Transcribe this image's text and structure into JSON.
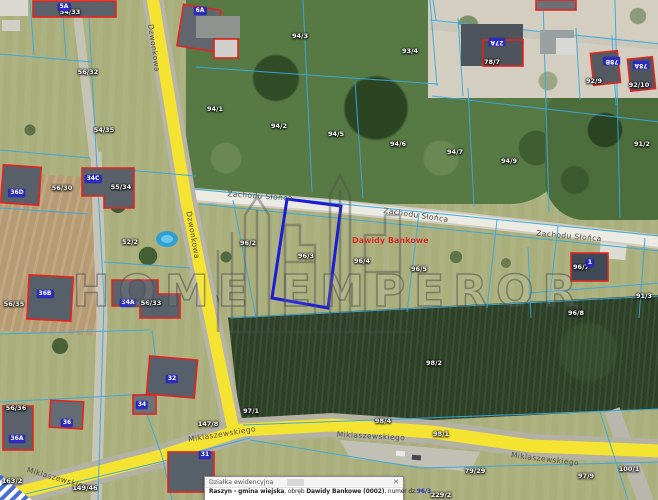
{
  "watermark": {
    "text": "HOME EMPEROR"
  },
  "map": {
    "place_label": "Dawidy Bankowe",
    "selected_parcel": "96/3",
    "colors": {
      "selected_parcel_outline": "#1b1bd9",
      "parcel_boundary_line": "#3aa8de",
      "road_fill": "#f5e332",
      "building_outline": "#e3241f",
      "building_tag_bg": "#2b2bc8",
      "place_label_text": "#cf2a21"
    },
    "street_labels": [
      {
        "text": "Dzwonkowa",
        "x": 154,
        "y": 48,
        "rot": 82
      },
      {
        "text": "Dzwonkowa",
        "x": 193,
        "y": 235,
        "rot": 80
      },
      {
        "text": "Zachodu Słońca",
        "x": 260,
        "y": 196,
        "rot": 4
      },
      {
        "text": "Zachodu Słońca",
        "x": 416,
        "y": 215,
        "rot": 8
      },
      {
        "text": "Zachodu Słońca",
        "x": 569,
        "y": 236,
        "rot": 5
      },
      {
        "text": "Miklaszewskiego",
        "x": 60,
        "y": 479,
        "rot": 16
      },
      {
        "text": "Miklaszewskiego",
        "x": 222,
        "y": 434,
        "rot": -9
      },
      {
        "text": "Miklaszewskiego",
        "x": 371,
        "y": 436,
        "rot": 3
      },
      {
        "text": "Miklaszewskiego",
        "x": 545,
        "y": 459,
        "rot": 7
      }
    ],
    "parcel_labels": [
      {
        "text": "54/33",
        "x": 70,
        "y": 12
      },
      {
        "text": "56/32",
        "x": 88,
        "y": 72
      },
      {
        "text": "54/35",
        "x": 104,
        "y": 130
      },
      {
        "text": "94/3",
        "x": 300,
        "y": 36
      },
      {
        "text": "93/4",
        "x": 410,
        "y": 51
      },
      {
        "text": "94/1",
        "x": 215,
        "y": 109
      },
      {
        "text": "94/2",
        "x": 279,
        "y": 126
      },
      {
        "text": "94/5",
        "x": 336,
        "y": 134
      },
      {
        "text": "94/6",
        "x": 398,
        "y": 144
      },
      {
        "text": "94/7",
        "x": 455,
        "y": 152
      },
      {
        "text": "94/9",
        "x": 509,
        "y": 161
      },
      {
        "text": "91/2",
        "x": 642,
        "y": 144
      },
      {
        "text": "78/7",
        "x": 492,
        "y": 62
      },
      {
        "text": "92/9",
        "x": 594,
        "y": 81
      },
      {
        "text": "92/10",
        "x": 639,
        "y": 85
      },
      {
        "text": "55/34",
        "x": 121,
        "y": 187
      },
      {
        "text": "56/30",
        "x": 62,
        "y": 188
      },
      {
        "text": "52/2",
        "x": 130,
        "y": 242
      },
      {
        "text": "96/2",
        "x": 248,
        "y": 243
      },
      {
        "text": "96/3",
        "x": 306,
        "y": 256
      },
      {
        "text": "96/4",
        "x": 362,
        "y": 261
      },
      {
        "text": "96/5",
        "x": 419,
        "y": 269
      },
      {
        "text": "96/7",
        "x": 581,
        "y": 267
      },
      {
        "text": "96/8",
        "x": 576,
        "y": 313
      },
      {
        "text": "91/3",
        "x": 644,
        "y": 296
      },
      {
        "text": "98/2",
        "x": 434,
        "y": 363
      },
      {
        "text": "56/35",
        "x": 14,
        "y": 304
      },
      {
        "text": "56/33",
        "x": 151,
        "y": 303
      },
      {
        "text": "56/36",
        "x": 16,
        "y": 408
      },
      {
        "text": "147/8",
        "x": 208,
        "y": 424
      },
      {
        "text": "97/1",
        "x": 251,
        "y": 411
      },
      {
        "text": "98/4",
        "x": 383,
        "y": 421
      },
      {
        "text": "98/1",
        "x": 441,
        "y": 434
      },
      {
        "text": "79/29",
        "x": 475,
        "y": 471
      },
      {
        "text": "97/9",
        "x": 586,
        "y": 476
      },
      {
        "text": "100/1",
        "x": 629,
        "y": 469
      },
      {
        "text": "229/2",
        "x": 441,
        "y": 495
      },
      {
        "text": "149/46",
        "x": 85,
        "y": 488
      },
      {
        "text": "163/2",
        "x": 12,
        "y": 481
      }
    ],
    "building_tags": [
      {
        "text": "5A",
        "x": 64,
        "y": 7,
        "flip": false
      },
      {
        "text": "6A",
        "x": 200,
        "y": 11,
        "flip": false
      },
      {
        "text": "27A",
        "x": 497,
        "y": 42,
        "flip": true
      },
      {
        "text": "78B",
        "x": 612,
        "y": 61,
        "flip": true
      },
      {
        "text": "78A",
        "x": 641,
        "y": 65,
        "flip": true
      },
      {
        "text": "36D",
        "x": 17,
        "y": 193,
        "flip": false
      },
      {
        "text": "34C",
        "x": 93,
        "y": 179,
        "flip": false
      },
      {
        "text": "36B",
        "x": 45,
        "y": 294,
        "flip": false
      },
      {
        "text": "34A",
        "x": 128,
        "y": 303,
        "flip": false
      },
      {
        "text": "32",
        "x": 172,
        "y": 379,
        "flip": false
      },
      {
        "text": "36A",
        "x": 17,
        "y": 439,
        "flip": false
      },
      {
        "text": "36",
        "x": 67,
        "y": 423,
        "flip": false
      },
      {
        "text": "34",
        "x": 142,
        "y": 405,
        "flip": false
      },
      {
        "text": "31",
        "x": 205,
        "y": 455,
        "flip": false
      },
      {
        "text": "1",
        "x": 590,
        "y": 263,
        "flip": false
      }
    ]
  },
  "info_panel": {
    "title": "Działka ewidencyjna",
    "close_glyph": "✕",
    "parts": [
      {
        "text": "Raszyn - gmina wiejska",
        "bold": true
      },
      {
        "text": ", obręb ",
        "bold": false
      },
      {
        "text": "Dawidy Bankowe (0002)",
        "bold": true
      },
      {
        "text": ", numer dz:",
        "bold": false
      },
      {
        "text": "96/3",
        "bold": true,
        "color": "#2233bb"
      }
    ]
  }
}
